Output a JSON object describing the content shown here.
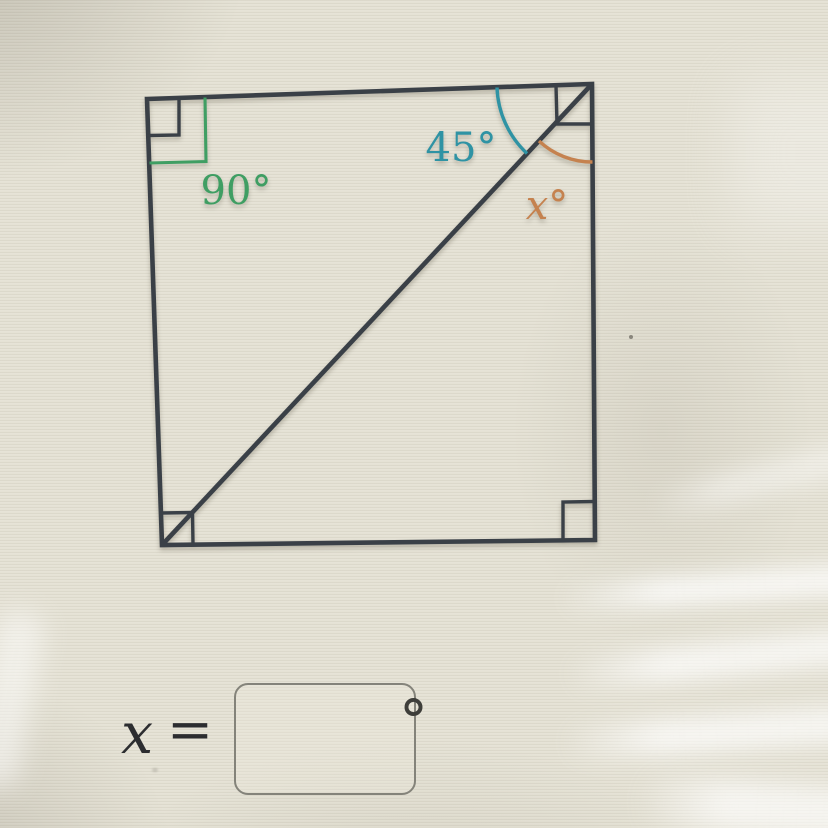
{
  "figure": {
    "line_color": "#3a4047",
    "angles": [
      {
        "label": "90°",
        "color": "#3f9e63"
      },
      {
        "label": "45°",
        "color": "#2f93a4"
      },
      {
        "label": "x°",
        "color": "#c5824f"
      }
    ]
  },
  "equation": {
    "variable": "x",
    "equals_sign": "=",
    "degree_symbol": "°",
    "input_value": ""
  }
}
